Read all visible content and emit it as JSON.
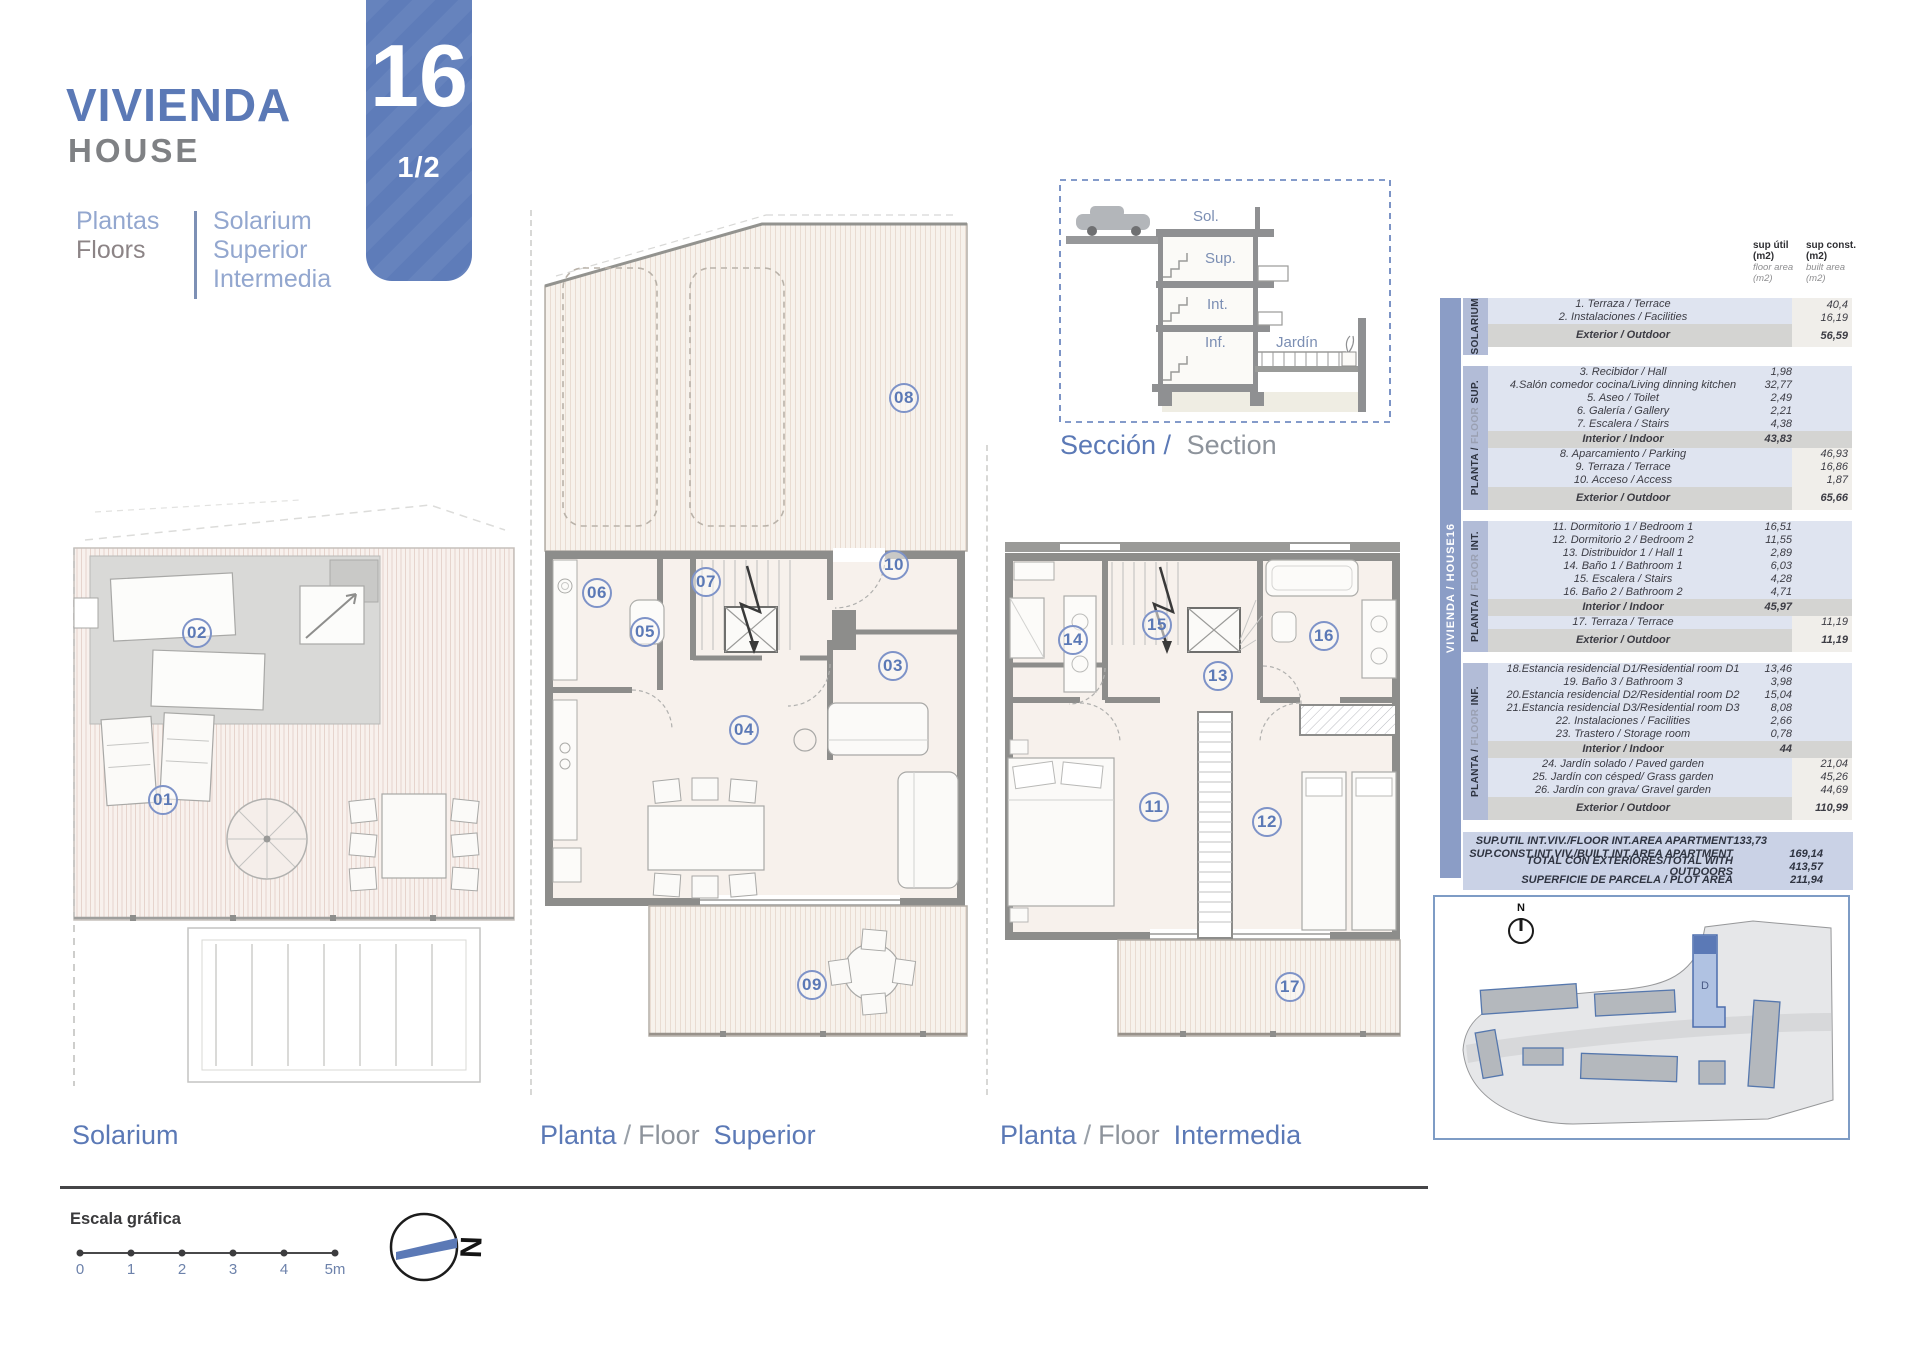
{
  "header": {
    "title_es": "VIVIENDA",
    "title_en": "HOUSE",
    "sub_left_es": "Plantas",
    "sub_left_en": "Floors",
    "sub_right": [
      "Solarium",
      "Superior",
      "Intermedia"
    ],
    "house_number": "16",
    "page_indicator": "1/2"
  },
  "plans": [
    {
      "id": "solarium",
      "caption": {
        "part1": "Solarium",
        "sep": "",
        "part2": "",
        "name": ""
      },
      "numbers": [
        "01",
        "02"
      ]
    },
    {
      "id": "superior",
      "caption": {
        "part1": "Planta",
        "sep": "/",
        "part2": "Floor",
        "name": "Superior"
      },
      "numbers": [
        "03",
        "04",
        "05",
        "06",
        "07",
        "08",
        "09",
        "10"
      ]
    },
    {
      "id": "intermedia",
      "caption": {
        "part1": "Planta",
        "sep": "/",
        "part2": "Floor",
        "name": "Intermedia"
      },
      "numbers": [
        "11",
        "12",
        "13",
        "14",
        "15",
        "16",
        "17"
      ]
    }
  ],
  "section_diagram": {
    "levels": [
      "Sol.",
      "Sup.",
      "Int.",
      "Inf."
    ],
    "garden_label": "Jardín",
    "caption_es": "Sección /",
    "caption_en": "Section"
  },
  "areas_table": {
    "sidebar_label": "VIVIENDA / HOUSE16",
    "col_headers": [
      {
        "title": "sup útil",
        "unit": "(m2)",
        "subtitle": "floor area",
        "subunit": "(m2)"
      },
      {
        "title": "sup const.",
        "unit": "(m2)",
        "subtitle": "built area",
        "subunit": "(m2)"
      }
    ],
    "sections": [
      {
        "tab_dark": "",
        "tab_light": "",
        "tab_bold": "SOLARIUM",
        "rows": [
          {
            "label": "1. Terraza / Terrace",
            "util": "",
            "const": "40,4",
            "type": "item"
          },
          {
            "label": "2. Instalaciones / Facilities",
            "util": "",
            "const": "16,19",
            "type": "item"
          },
          {
            "label": "Exterior / Outdoor",
            "util": "",
            "const": "56,59",
            "type": "subtotal"
          }
        ]
      },
      {
        "tab_dark": "PLANTA /",
        "tab_light": "FLOOR",
        "tab_bold": "SUP.",
        "rows": [
          {
            "label": "3. Recibidor / Hall",
            "util": "1,98",
            "const": "",
            "type": "item"
          },
          {
            "label": "4.Salón comedor cocina/Living dinning kitchen",
            "util": "32,77",
            "const": "",
            "type": "item"
          },
          {
            "label": "5. Aseo / Toilet",
            "util": "2,49",
            "const": "",
            "type": "item"
          },
          {
            "label": "6. Galería / Gallery",
            "util": "2,21",
            "const": "",
            "type": "item"
          },
          {
            "label": "7. Escalera / Stairs",
            "util": "4,38",
            "const": "",
            "type": "item"
          },
          {
            "label": "Interior / Indoor",
            "util": "43,83",
            "const": "",
            "type": "subtotal"
          },
          {
            "label": "8. Aparcamiento / Parking",
            "util": "",
            "const": "46,93",
            "type": "item"
          },
          {
            "label": "9. Terraza / Terrace",
            "util": "",
            "const": "16,86",
            "type": "item"
          },
          {
            "label": "10. Acceso / Access",
            "util": "",
            "const": "1,87",
            "type": "item"
          },
          {
            "label": "Exterior / Outdoor",
            "util": "",
            "const": "65,66",
            "type": "subtotal"
          }
        ]
      },
      {
        "tab_dark": "PLANTA /",
        "tab_light": "FLOOR",
        "tab_bold": "INT.",
        "rows": [
          {
            "label": "11. Dormitorio 1 / Bedroom 1",
            "util": "16,51",
            "const": "",
            "type": "item"
          },
          {
            "label": "12.  Dormitorio 2 / Bedroom 2",
            "util": "11,55",
            "const": "",
            "type": "item"
          },
          {
            "label": "13. Distribuidor 1 / Hall 1",
            "util": "2,89",
            "const": "",
            "type": "item"
          },
          {
            "label": "14. Baño 1 / Bathroom 1",
            "util": "6,03",
            "const": "",
            "type": "item"
          },
          {
            "label": "15. Escalera / Stairs",
            "util": "4,28",
            "const": "",
            "type": "item"
          },
          {
            "label": "16. Baño 2 / Bathroom 2",
            "util": "4,71",
            "const": "",
            "type": "item"
          },
          {
            "label": "Interior / Indoor",
            "util": "45,97",
            "const": "",
            "type": "subtotal"
          },
          {
            "label": "17. Terraza / Terrace",
            "util": "",
            "const": "11,19",
            "type": "item"
          },
          {
            "label": "Exterior / Outdoor",
            "util": "",
            "const": "11,19",
            "type": "subtotal"
          }
        ]
      },
      {
        "tab_dark": "PLANTA /",
        "tab_light": "FLOOR",
        "tab_bold": "INF.",
        "rows": [
          {
            "label": "18.Estancia residencial D1/Residential room D1",
            "util": "13,46",
            "const": "",
            "type": "item"
          },
          {
            "label": "19. Baño 3 / Bathroom 3",
            "util": "3,98",
            "const": "",
            "type": "item"
          },
          {
            "label": "20.Estancia residencial D2/Residential room D2",
            "util": "15,04",
            "const": "",
            "type": "item"
          },
          {
            "label": "21.Estancia residencial D3/Residential room D3",
            "util": "8,08",
            "const": "",
            "type": "item"
          },
          {
            "label": "22. Instalaciones / Facilities",
            "util": "2,66",
            "const": "",
            "type": "item"
          },
          {
            "label": "23. Trastero / Storage room",
            "util": "0,78",
            "const": "",
            "type": "item"
          },
          {
            "label": "Interior / Indoor",
            "util": "44",
            "const": "",
            "type": "subtotal"
          },
          {
            "label": "24. Jardín solado / Paved garden",
            "util": "",
            "const": "21,04",
            "type": "item"
          },
          {
            "label": "25. Jardín con césped/ Grass garden",
            "util": "",
            "const": "45,26",
            "type": "item"
          },
          {
            "label": "26. Jardín con grava/ Gravel garden",
            "util": "",
            "const": "44,69",
            "type": "item"
          },
          {
            "label": "Exterior / Outdoor",
            "util": "",
            "const": "110,99",
            "type": "subtotal"
          }
        ]
      }
    ],
    "totals": [
      {
        "label": "SUP.UTIL INT.VIV./FLOOR INT.AREA APARTMENT",
        "util": "133,73",
        "const": ""
      },
      {
        "label": "SUP.CONST.INT.VIV./BUILT INT.AREA APARTMENT",
        "util": "",
        "const": "169,14"
      },
      {
        "label": "TOTAL CON EXTERIORES/TOTAL WITH OUTDOORS",
        "util": "",
        "const": "413,57"
      },
      {
        "label": "SUPERFICIE DE PARCELA / PLOT AREA",
        "util": "",
        "const": "211,94"
      }
    ]
  },
  "siteplan": {
    "north_label": "N",
    "building_label": "D"
  },
  "scale_bar": {
    "title": "Escala gráfica",
    "ticks": [
      "0",
      "1",
      "2",
      "3",
      "4",
      "5m"
    ],
    "north_label": "N"
  }
}
